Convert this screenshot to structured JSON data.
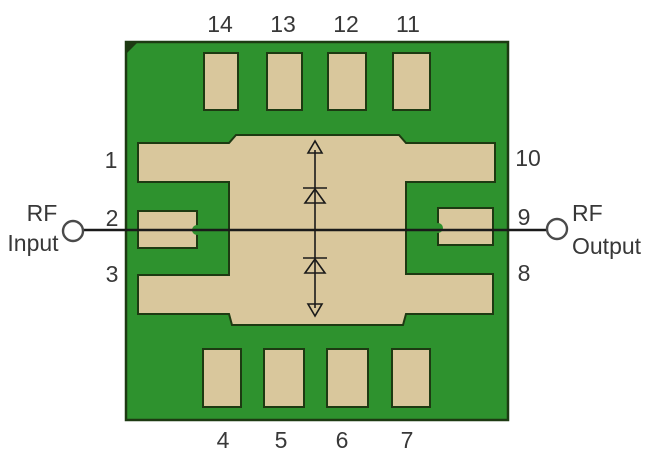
{
  "diagram": {
    "description_labels": {
      "rf_input_line1": "RF",
      "rf_input_line2": "Input",
      "rf_output_line1": "RF",
      "rf_output_line2": "Output"
    },
    "pins": {
      "top": [
        "14",
        "13",
        "12",
        "11"
      ],
      "bottom": [
        "4",
        "5",
        "6",
        "7"
      ],
      "left": [
        "1",
        "2",
        "3"
      ],
      "right": [
        "10",
        "9",
        "8"
      ]
    },
    "colors": {
      "background": "#ffffff",
      "board_green": "#2e922e",
      "pad_tan": "#d9c79c",
      "outline": "#1d3a12",
      "line": "#1a1a1a",
      "label_text": "#383838",
      "terminal_stroke": "#4a4a4a"
    }
  }
}
